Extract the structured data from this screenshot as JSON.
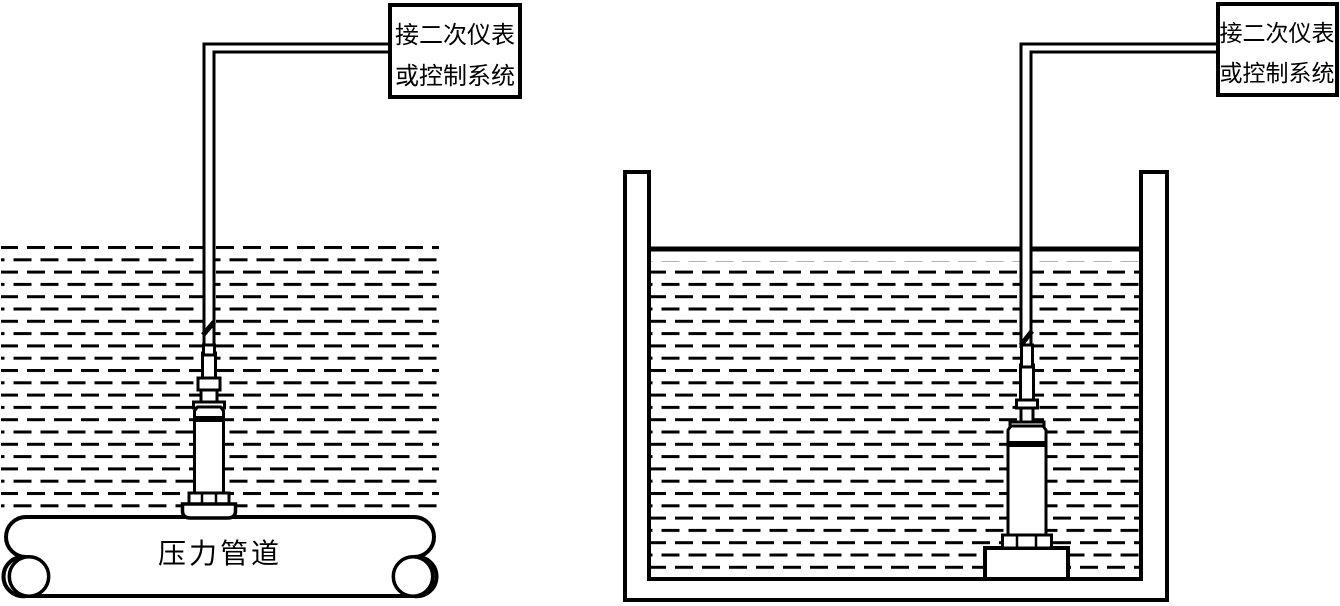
{
  "colors": {
    "line": "#000000",
    "background": "#ffffff"
  },
  "left_figure": {
    "description": "pressure transmitter mounted on a pressure pipe",
    "box_line1": "接二次仪表",
    "box_line2": "或控制系统",
    "pipe_label": "压力管道"
  },
  "right_figure": {
    "description": "submersible level transmitter standing in a liquid tank",
    "box_line1": "接二次仪表",
    "box_line2": "或控制系统"
  }
}
